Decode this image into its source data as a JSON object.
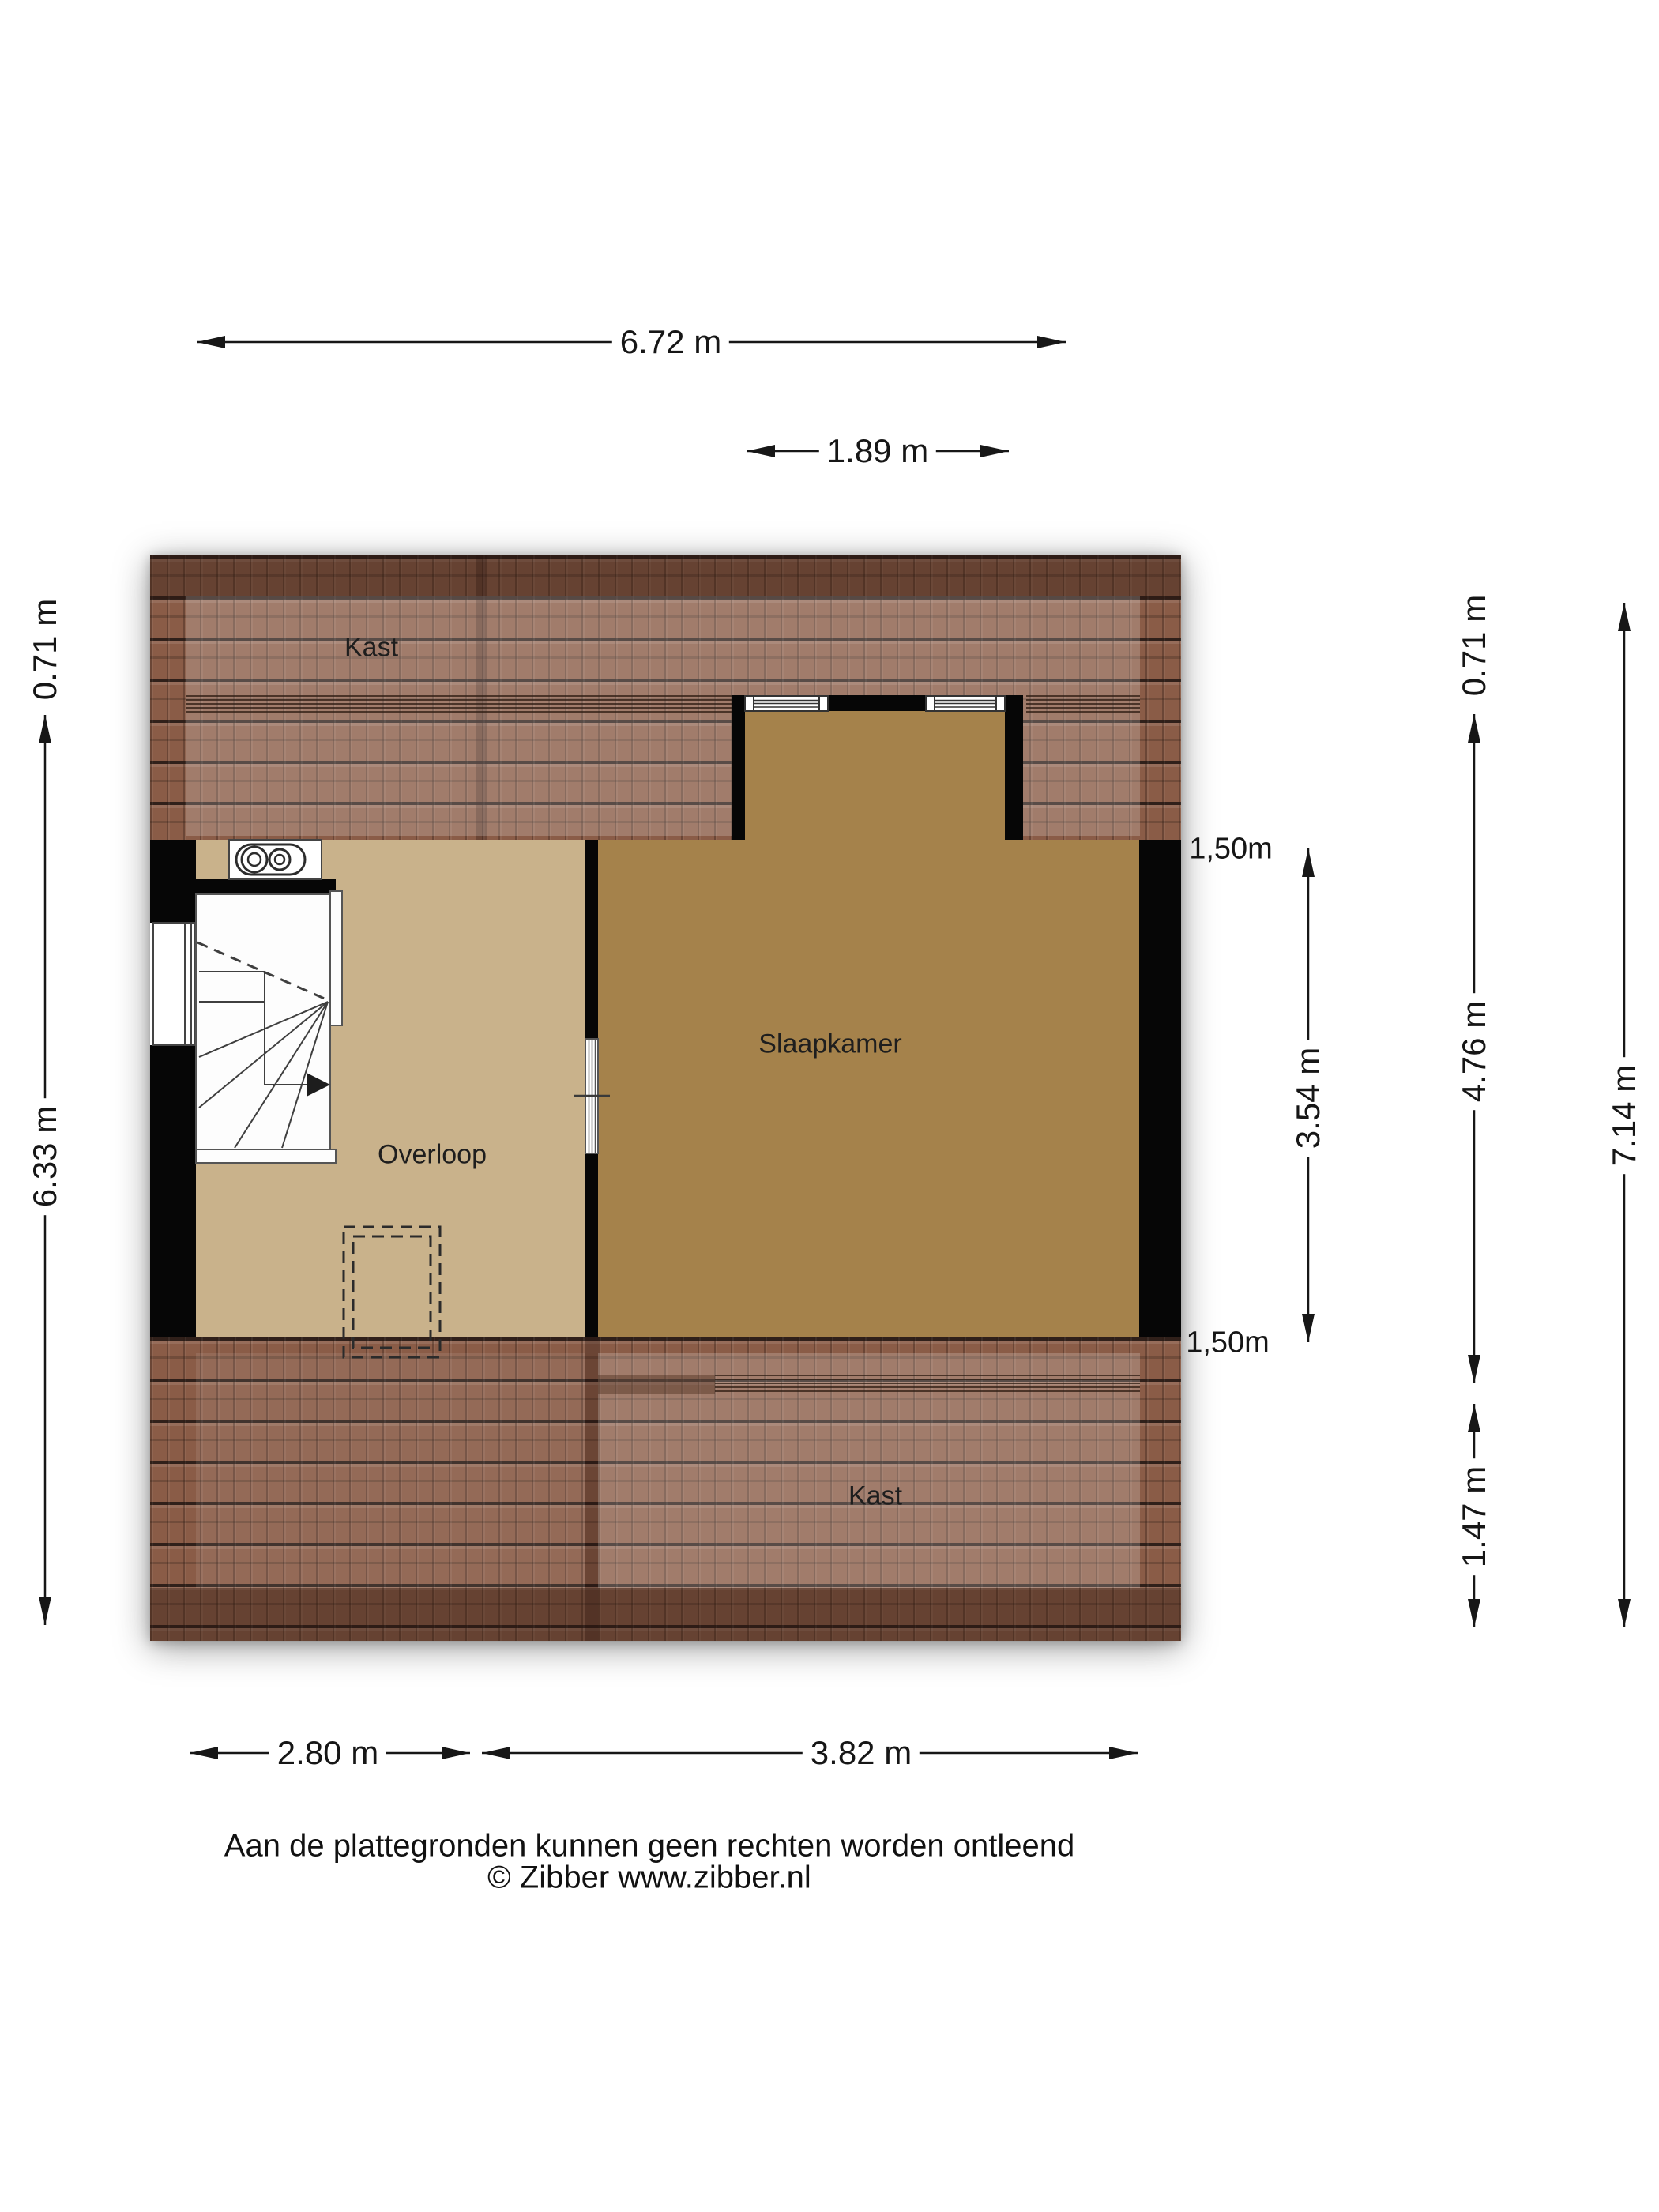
{
  "meta": {
    "type": "floor-plan",
    "provider_note": "Zibber plattegrond"
  },
  "rooms": {
    "kast_top": "Kast",
    "overloop": "Overloop",
    "slaapkamer": "Slaapkamer",
    "kast_bottom": "Kast"
  },
  "dimensions": {
    "top_total": "6.72 m",
    "dormer_width": "1.89 m",
    "left_upper": "0.71 m",
    "left_total": "6.33 m",
    "right_upper": "0.71 m",
    "right_middle": "4.76 m",
    "right_lower": "1.47 m",
    "right_total": "7.14 m",
    "slaapkamer_depth": "3.54 m",
    "headroom_top": "1,50m",
    "headroom_bottom": "1,50m",
    "bottom_overloop": "2.80 m",
    "bottom_slaapkamer": "3.82 m"
  },
  "footer": {
    "disclaimer": "Aan de plattegronden kunnen geen rechten worden ontleend",
    "copyright": "© Zibber www.zibber.nl"
  },
  "colors": {
    "roof_tile": "#8a5c47",
    "roof_line": "#30201a",
    "floor_overloop": "#c9b28b",
    "floor_slaapkamer": "#a5824b",
    "wall": "#060606",
    "dimension_text": "#161616"
  }
}
